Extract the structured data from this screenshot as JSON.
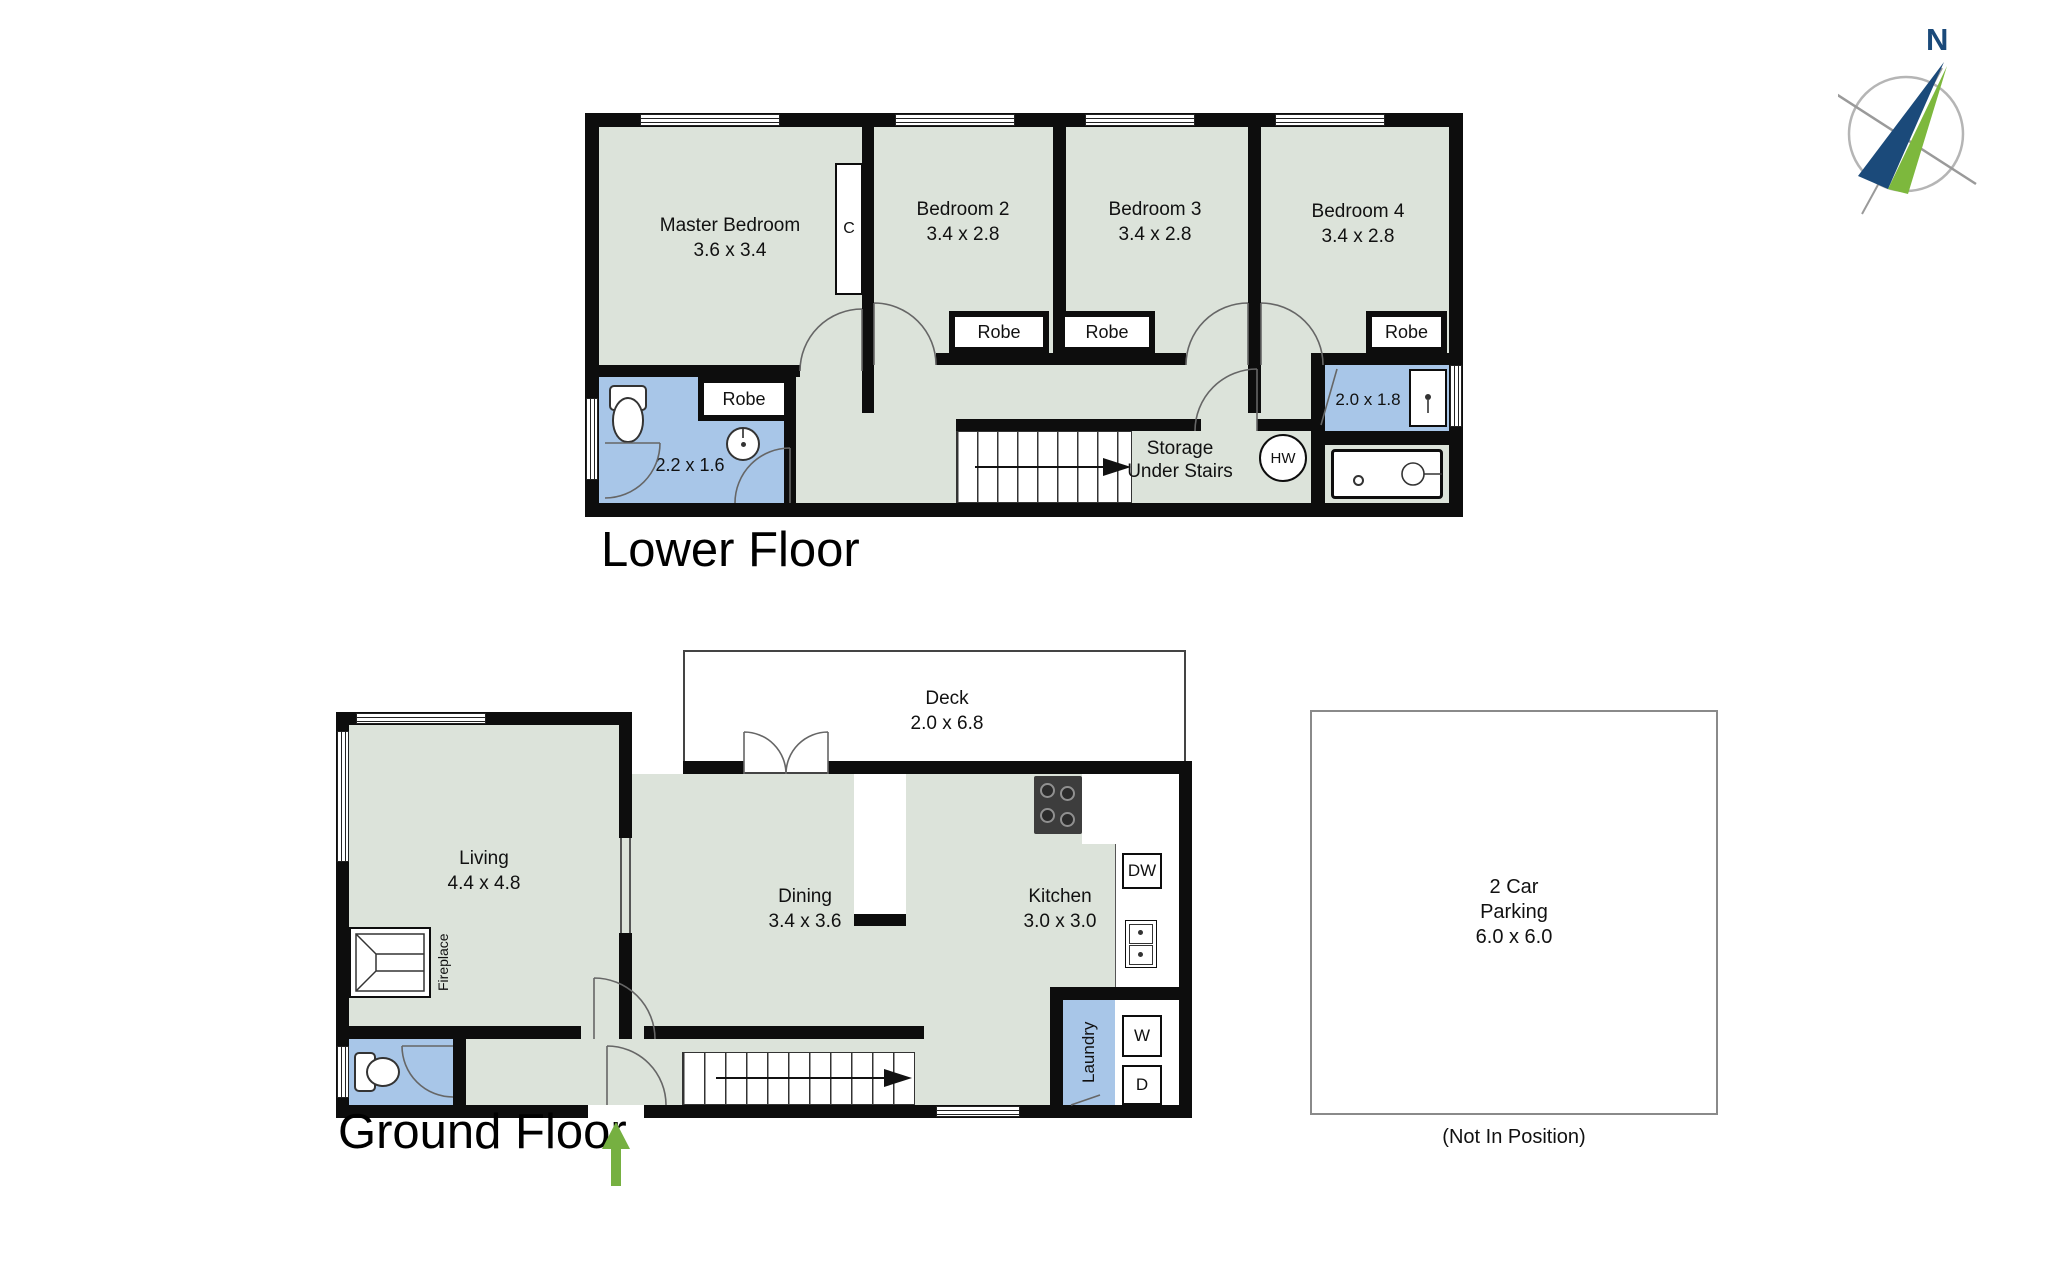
{
  "compass": {
    "north_label": "N"
  },
  "shared": {
    "robe_label": "Robe"
  },
  "lower_floor": {
    "title": "Lower Floor",
    "master": {
      "name": "Master Bedroom",
      "dims": "3.6 x 3.4"
    },
    "bedroom2": {
      "name": "Bedroom 2",
      "dims": "3.4 x 2.8"
    },
    "bedroom3": {
      "name": "Bedroom 3",
      "dims": "3.4 x 2.8"
    },
    "bedroom4": {
      "name": "Bedroom 4",
      "dims": "3.4 x 2.8"
    },
    "closet_label": "C",
    "bathroom_dims": "2.2 x 1.6",
    "ensuite_dims": "2.0 x 1.8",
    "storage_line1": "Storage",
    "storage_line2": "Under Stairs",
    "hot_water_label": "HW"
  },
  "ground_floor": {
    "title": "Ground Floor",
    "living": {
      "name": "Living",
      "dims": "4.4 x 4.8"
    },
    "dining": {
      "name": "Dining",
      "dims": "3.4 x 3.6"
    },
    "kitchen": {
      "name": "Kitchen",
      "dims": "3.0 x 3.0"
    },
    "deck": {
      "name": "Deck",
      "dims": "2.0 x 6.8"
    },
    "laundry_label": "Laundry",
    "fireplace_label": "Fireplace",
    "dishwasher_label": "DW",
    "washer_label": "W",
    "dryer_label": "D"
  },
  "parking": {
    "line1": "2 Car",
    "line2": "Parking",
    "line3": "6.0 x 6.0",
    "note": "(Not In Position)"
  },
  "colors": {
    "room_fill": "#dce3da",
    "wet_fill": "#a8c6e8",
    "wall": "#0d0d0d",
    "arrow_green": "#76b041",
    "compass_navy": "#1b4a7a",
    "compass_green": "#7db83d"
  }
}
